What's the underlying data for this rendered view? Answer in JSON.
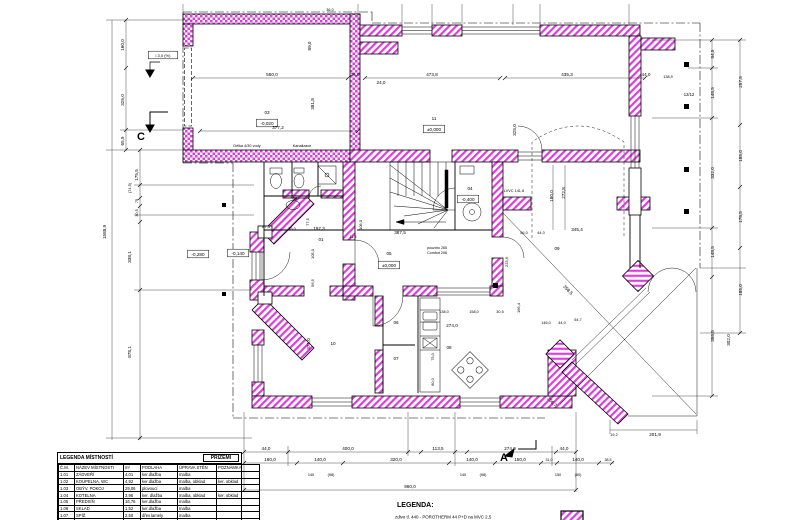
{
  "legend_table": {
    "title": "LEGENDA  MÍSTNOSTÍ",
    "floor": "PŘÍZEMÍ",
    "headers": [
      "Č.M.",
      "NÁZEV MÍSTNOSTI",
      "m²",
      "PODLAHA",
      "ÚPRAVA STĚN",
      "POZNÁMKA"
    ],
    "rows": [
      [
        "1.01",
        "ZÁDVEŘÍ",
        "4,01",
        "ker.dlažba",
        "malba",
        ""
      ],
      [
        "1.02",
        "KOUPELNA, WC",
        "4,92",
        "ker.dlažba",
        "malba, obklad",
        "ker. obklad"
      ],
      [
        "1.03",
        "OBÝV. POKOJ",
        "29,06",
        "plovoucí",
        "malba",
        ""
      ],
      [
        "1.04",
        "KOTELNA",
        "3,96",
        "ker. dlažba",
        "malba, obklad",
        "ker. obklad"
      ],
      [
        "1.05",
        "PŘEDSÍŇ",
        "16,76",
        "ker.dlažba",
        "malba",
        ""
      ],
      [
        "1.06",
        "SKLAD",
        "1,52",
        "ker.dlažba",
        "malba",
        ""
      ],
      [
        "1.07",
        "SPÍŽ",
        "2,50",
        "dřev.lamely",
        "malba",
        ""
      ],
      [
        "1.08",
        "KUCHYNĚ",
        "11,71",
        "dřev.lamely",
        "malba",
        ""
      ]
    ]
  },
  "legend": {
    "title": "LEGENDA:",
    "wall_item": "zdivo tl. 440 - POROTHERM 44 P+D na MVC 2,5"
  },
  "colors": {
    "wall_hatch": "#dd3ddd",
    "line": "#000000"
  },
  "plan": {
    "labels": [
      {
        "t": "03",
        "x": 267,
        "y": 114
      },
      {
        "t": "-0,020",
        "x": 267,
        "y": 125,
        "b": 1
      },
      {
        "t": "11",
        "x": 434,
        "y": 120
      },
      {
        "t": "±0,000",
        "x": 434,
        "y": 131,
        "b": 1
      },
      {
        "t": "01",
        "x": 321,
        "y": 241
      },
      {
        "t": "02",
        "x": 295,
        "y": 200
      },
      {
        "t": "04",
        "x": 470,
        "y": 190
      },
      {
        "t": "-0,400",
        "x": 468,
        "y": 201,
        "b": 1
      },
      {
        "t": "05",
        "x": 389,
        "y": 255
      },
      {
        "t": "±0,000",
        "x": 389,
        "y": 267,
        "b": 1
      },
      {
        "t": "06",
        "x": 396,
        "y": 324
      },
      {
        "t": "07",
        "x": 396,
        "y": 360
      },
      {
        "t": "08",
        "x": 449,
        "y": 349
      },
      {
        "t": "09",
        "x": 557,
        "y": 250
      },
      {
        "t": "10",
        "x": 333,
        "y": 345
      },
      {
        "t": "-0,140",
        "x": 238,
        "y": 255,
        "b": 1
      },
      {
        "t": "-0,280",
        "x": 198,
        "y": 256,
        "b": 1
      },
      {
        "t": "Délka 4/30 vody",
        "x": 247,
        "y": 147,
        "s": 3.8
      },
      {
        "t": "Kanalizace",
        "x": 302,
        "y": 147,
        "s": 3.8
      },
      {
        "t": "LVVC 141,8",
        "x": 514,
        "y": 192,
        "s": 3.8
      },
      {
        "t": "pouzdro 265",
        "x": 437,
        "y": 249,
        "s": 3.6
      },
      {
        "t": "Comfort 298",
        "x": 437,
        "y": 254,
        "s": 3.6
      },
      {
        "t": "12/12",
        "x": 689,
        "y": 96,
        "s": 4.2
      },
      {
        "t": "i 3,0 (%)",
        "x": 163,
        "y": 57,
        "s": 4,
        "b": 1
      },
      {
        "t": "C",
        "x": 141,
        "y": 140,
        "s": 11,
        "w": 1
      },
      {
        "t": "A",
        "x": 504,
        "y": 461,
        "s": 11,
        "w": 1
      },
      {
        "t": "550,0",
        "x": 272,
        "y": 76
      },
      {
        "t": "35,0",
        "x": 355,
        "y": 76
      },
      {
        "t": "24,0",
        "x": 381,
        "y": 84
      },
      {
        "t": "377,2",
        "x": 278,
        "y": 129
      },
      {
        "t": "89,0",
        "x": 311,
        "y": 46,
        "r": -90
      },
      {
        "t": "381,8",
        "x": 314,
        "y": 104,
        "r": -90
      },
      {
        "t": "473,8",
        "x": 432,
        "y": 76
      },
      {
        "t": "435,3",
        "x": 567,
        "y": 76
      },
      {
        "t": "44,0",
        "x": 646,
        "y": 76
      },
      {
        "t": "325,0",
        "x": 516,
        "y": 130,
        "r": -90
      },
      {
        "t": "180,0",
        "x": 553,
        "y": 196,
        "r": -90
      },
      {
        "t": "272,8",
        "x": 565,
        "y": 193,
        "r": -90
      },
      {
        "t": "36,0",
        "x": 330,
        "y": 11,
        "s": 3.8
      },
      {
        "t": "138,9",
        "x": 668,
        "y": 78,
        "s": 3.8
      },
      {
        "t": "84,5",
        "x": 714,
        "y": 54,
        "r": -90
      },
      {
        "t": "148,5",
        "x": 714,
        "y": 93,
        "r": -90
      },
      {
        "t": "332,0",
        "x": 714,
        "y": 173,
        "r": -90
      },
      {
        "t": "148,5",
        "x": 714,
        "y": 252,
        "r": -90
      },
      {
        "t": "358,5",
        "x": 714,
        "y": 336,
        "r": -90
      },
      {
        "t": "257,5",
        "x": 742,
        "y": 82,
        "r": -90
      },
      {
        "t": "185,0",
        "x": 742,
        "y": 156,
        "r": -90
      },
      {
        "t": "178,5",
        "x": 742,
        "y": 217,
        "r": -90
      },
      {
        "t": "185,0",
        "x": 742,
        "y": 290,
        "r": -90
      },
      {
        "t": "302,0",
        "x": 730,
        "y": 340,
        "r": -90
      },
      {
        "t": "201,9",
        "x": 655,
        "y": 436
      },
      {
        "t": "19,2",
        "x": 614,
        "y": 436,
        "s": 3.8
      },
      {
        "t": "387,5",
        "x": 400,
        "y": 234
      },
      {
        "t": "345,4",
        "x": 577,
        "y": 231
      },
      {
        "t": "197,3",
        "x": 319,
        "y": 230
      },
      {
        "t": "35,0",
        "x": 292,
        "y": 230,
        "s": 4
      },
      {
        "t": "87,3",
        "x": 266,
        "y": 228,
        "s": 4
      },
      {
        "t": "77,5",
        "x": 309,
        "y": 222,
        "r": -90,
        "s": 4
      },
      {
        "t": "11,5",
        "x": 353,
        "y": 238,
        "s": 3.8
      },
      {
        "t": "108,0",
        "x": 362,
        "y": 225,
        "r": -90,
        "s": 4
      },
      {
        "t": "105,0",
        "x": 314,
        "y": 254,
        "r": -90,
        "s": 4
      },
      {
        "t": "56,5",
        "x": 314,
        "y": 283,
        "r": -90,
        "s": 4
      },
      {
        "t": "223,6",
        "x": 508,
        "y": 262,
        "r": -90,
        "s": 4
      },
      {
        "t": "166,4",
        "x": 520,
        "y": 308,
        "r": -90,
        "s": 4
      },
      {
        "t": "358,5",
        "x": 567,
        "y": 291,
        "r": 45
      },
      {
        "t": "256,7",
        "x": 551,
        "y": 403,
        "r": 45
      },
      {
        "t": "56,0",
        "x": 524,
        "y": 234,
        "s": 3.8
      },
      {
        "t": "44,0",
        "x": 541,
        "y": 234,
        "s": 3.8
      },
      {
        "t": "146,0",
        "x": 546,
        "y": 324,
        "s": 3.8
      },
      {
        "t": "44,0",
        "x": 562,
        "y": 324,
        "s": 3.8
      },
      {
        "t": "54,7",
        "x": 578,
        "y": 321,
        "s": 3.8
      },
      {
        "t": "371,0",
        "x": 310,
        "y": 344,
        "r": -90
      },
      {
        "t": "138,0",
        "x": 444,
        "y": 313,
        "s": 3.8
      },
      {
        "t": "158,0",
        "x": 474,
        "y": 313,
        "s": 3.8
      },
      {
        "t": "30,5",
        "x": 500,
        "y": 313,
        "s": 3.8
      },
      {
        "t": "274,0",
        "x": 452,
        "y": 327
      },
      {
        "t": "75,0",
        "x": 434,
        "y": 357,
        "r": -90,
        "s": 3.8
      },
      {
        "t": "80,0",
        "x": 434,
        "y": 382,
        "r": -90,
        "s": 3.8
      },
      {
        "t": "1588,9",
        "x": 106,
        "y": 232,
        "r": -90
      },
      {
        "t": "160,0",
        "x": 124,
        "y": 45,
        "r": -90
      },
      {
        "t": "325,0",
        "x": 124,
        "y": 100,
        "r": -90
      },
      {
        "t": "65,9",
        "x": 124,
        "y": 141,
        "r": -90
      },
      {
        "t": "175,5",
        "x": 138,
        "y": 175,
        "r": -90
      },
      {
        "t": "(74,5)",
        "x": 131,
        "y": 188,
        "r": -90,
        "s": 3.8
      },
      {
        "t": "75",
        "x": 138,
        "y": 201,
        "r": -90,
        "s": 3.8
      },
      {
        "t": "30,5",
        "x": 138,
        "y": 213,
        "r": -90,
        "s": 3.8
      },
      {
        "t": "338,1",
        "x": 131,
        "y": 257,
        "r": -90
      },
      {
        "t": "878,1",
        "x": 131,
        "y": 352,
        "r": -90
      },
      {
        "t": "44,0",
        "x": 266,
        "y": 450
      },
      {
        "t": "400,0",
        "x": 348,
        "y": 450
      },
      {
        "t": "113,5",
        "x": 438,
        "y": 450
      },
      {
        "t": "274,0",
        "x": 510,
        "y": 450
      },
      {
        "t": "44,0",
        "x": 564,
        "y": 450
      },
      {
        "t": "160,0",
        "x": 270,
        "y": 461
      },
      {
        "t": "140,0",
        "x": 320,
        "y": 461
      },
      {
        "t": "320,0",
        "x": 396,
        "y": 461
      },
      {
        "t": "140,0",
        "x": 472,
        "y": 461
      },
      {
        "t": "150,0",
        "x": 520,
        "y": 461
      },
      {
        "t": "31,0",
        "x": 549,
        "y": 461,
        "s": 3.6
      },
      {
        "t": "140,0",
        "x": 578,
        "y": 461
      },
      {
        "t": "38,5",
        "x": 608,
        "y": 461,
        "s": 3.6
      },
      {
        "t": "140",
        "x": 311,
        "y": 476,
        "s": 3.8
      },
      {
        "t": "(98)",
        "x": 331,
        "y": 476,
        "s": 3.8
      },
      {
        "t": "140",
        "x": 463,
        "y": 476,
        "s": 3.8
      },
      {
        "t": "(98)",
        "x": 483,
        "y": 476,
        "s": 3.8
      },
      {
        "t": "150",
        "x": 558,
        "y": 476,
        "s": 3.8
      },
      {
        "t": "(80)",
        "x": 578,
        "y": 476,
        "s": 3.8
      },
      {
        "t": "960,0",
        "x": 410,
        "y": 488
      }
    ]
  }
}
